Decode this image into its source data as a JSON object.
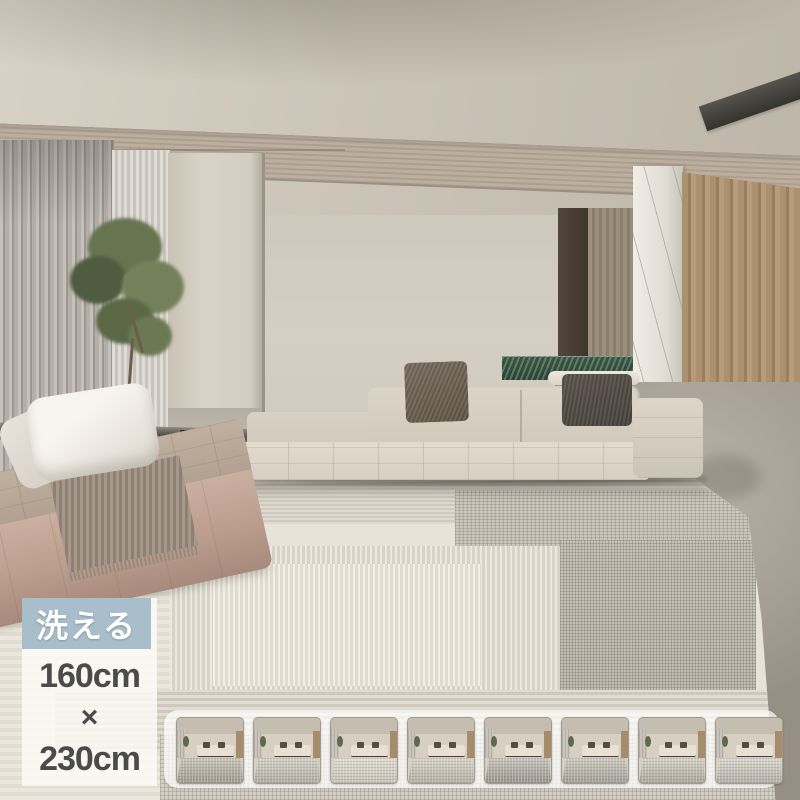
{
  "badge": {
    "label": "洗える",
    "background_color": "#a8becb",
    "text_color": "#ffffff"
  },
  "size_overlay": {
    "panel_background": "rgba(253,252,249,0.8)",
    "text_color": "#4b4b4b",
    "width_label": "160cm",
    "separator": "×",
    "length_label": "230cm"
  },
  "thumbnail_strip": {
    "count": 8,
    "items": [
      {
        "rug_top": "#c9c4b9",
        "rug_bottom": "#9f9a8f"
      },
      {
        "rug_top": "#d3cfc5",
        "rug_bottom": "#b0aca1"
      },
      {
        "rug_top": "#e0dcd1",
        "rug_bottom": "#c6c2b7"
      },
      {
        "rug_top": "#d8d3c6",
        "rug_bottom": "#b5afa2"
      },
      {
        "rug_top": "#c7c4bc",
        "rug_bottom": "#97948b"
      },
      {
        "rug_top": "#ccc9c0",
        "rug_bottom": "#a19e95"
      },
      {
        "rug_top": "#d5d1c6",
        "rug_bottom": "#aaa69b"
      },
      {
        "rug_top": "#d9d6cd",
        "rug_bottom": "#b1aea5"
      }
    ]
  },
  "scene_colors": {
    "ceiling": "#c9c2b5",
    "wall": "#d0cabe",
    "sofa": "#dbd4c6",
    "daybed": "#c2a595",
    "rug_base": "#e7e3d9",
    "concrete_floor": "#a8a197",
    "wood_wall": "#a58b69",
    "green_marble": "#31493a",
    "marble_partition": "#e9e6df"
  }
}
